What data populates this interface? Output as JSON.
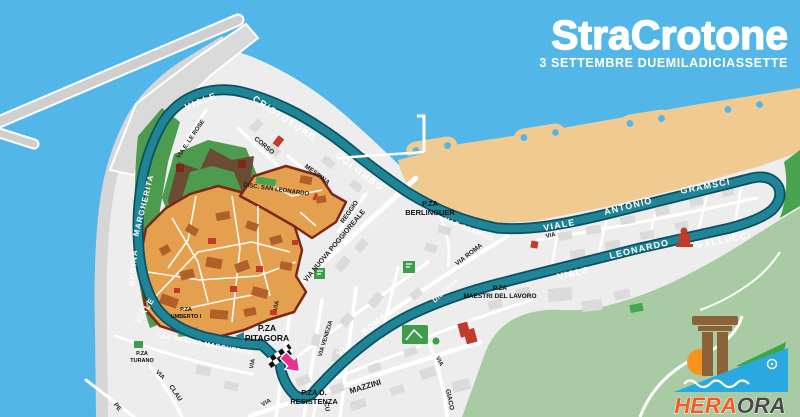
{
  "title": {
    "stra": "Stra",
    "crotone": "Crotone",
    "subtitle": "3 SETTEMBRE DUEMILADICIASSETTE"
  },
  "route_labels": {
    "viale_top": "VIALE",
    "cristoforo": "CRISTOFORO",
    "colombo": "COLOMBO",
    "margherita_west": "MARGHERITA",
    "regina_west": "REGINA",
    "viale_west": "VIALE",
    "regina_margherita_south": "V.LE REGINA MARGHERITA",
    "via_roma_via": "VIA",
    "via_roma_roma": "ROMA",
    "discesa": "DISCESA",
    "vle_gramsci": "V.LE GRAMSCI",
    "viale_beach": "VIALE",
    "antonio": "ANTONIO",
    "gramsci": "GRAMSCI",
    "viale_return": "VIALE",
    "leonardo": "LEONARDO",
    "gallucci": "GALLUCCI"
  },
  "street_labels": {
    "le_rose": "VIA E. LE ROSE",
    "corso": "CORSO",
    "messina": "MESSINA",
    "disc_san_leonardo": "DISC. SAN LEONARDO",
    "reggio": "REGGIO",
    "poggioreale": "VIA NUOVA POGGIOREALE",
    "via_roma_black": "VIA ROMA",
    "venezia": "VIA VENEZIA",
    "mazzini": "MAZZINI",
    "via_1": "VIA",
    "via_2": "VIA",
    "via_3": "VIA",
    "via_4": "VIA",
    "via_5": "VIA",
    "via_6": "VIA",
    "giaco": "GIACO",
    "clau": "CLAU",
    "cu": "CU",
    "pe": "PE"
  },
  "places": {
    "berlinguer_1": "P.ZA",
    "berlinguer_2": "BERLINGUER",
    "maestri_1": "P.ZA",
    "maestri_2": "MAESTRI DEL LAVORO",
    "pitagora_1": "P.ZA",
    "pitagora_2": "PITAGORA",
    "resistenza_1": "P.ZA D.",
    "resistenza_2": "RESISTENZA",
    "umberto_1": "P.ZA",
    "umberto_2": "UMBERTO I",
    "turano_1": "P.ZA",
    "turano_2": "TURANO"
  },
  "logo": {
    "hera": "HERA",
    "ora": "ORA"
  },
  "colors": {
    "sea": "#52B7E8",
    "route": "#1E8496",
    "route_edge": "#0C5161",
    "beach": "#F0CA90",
    "old_town": "#E5A04F",
    "old_town_outline": "#7B2817",
    "park_green": "#3F9C4C",
    "hill_green": "#A8CBA4",
    "marker_red": "#C23B28",
    "finish_pink": "#EC2E8F",
    "title_white": "#FFFFFF"
  }
}
